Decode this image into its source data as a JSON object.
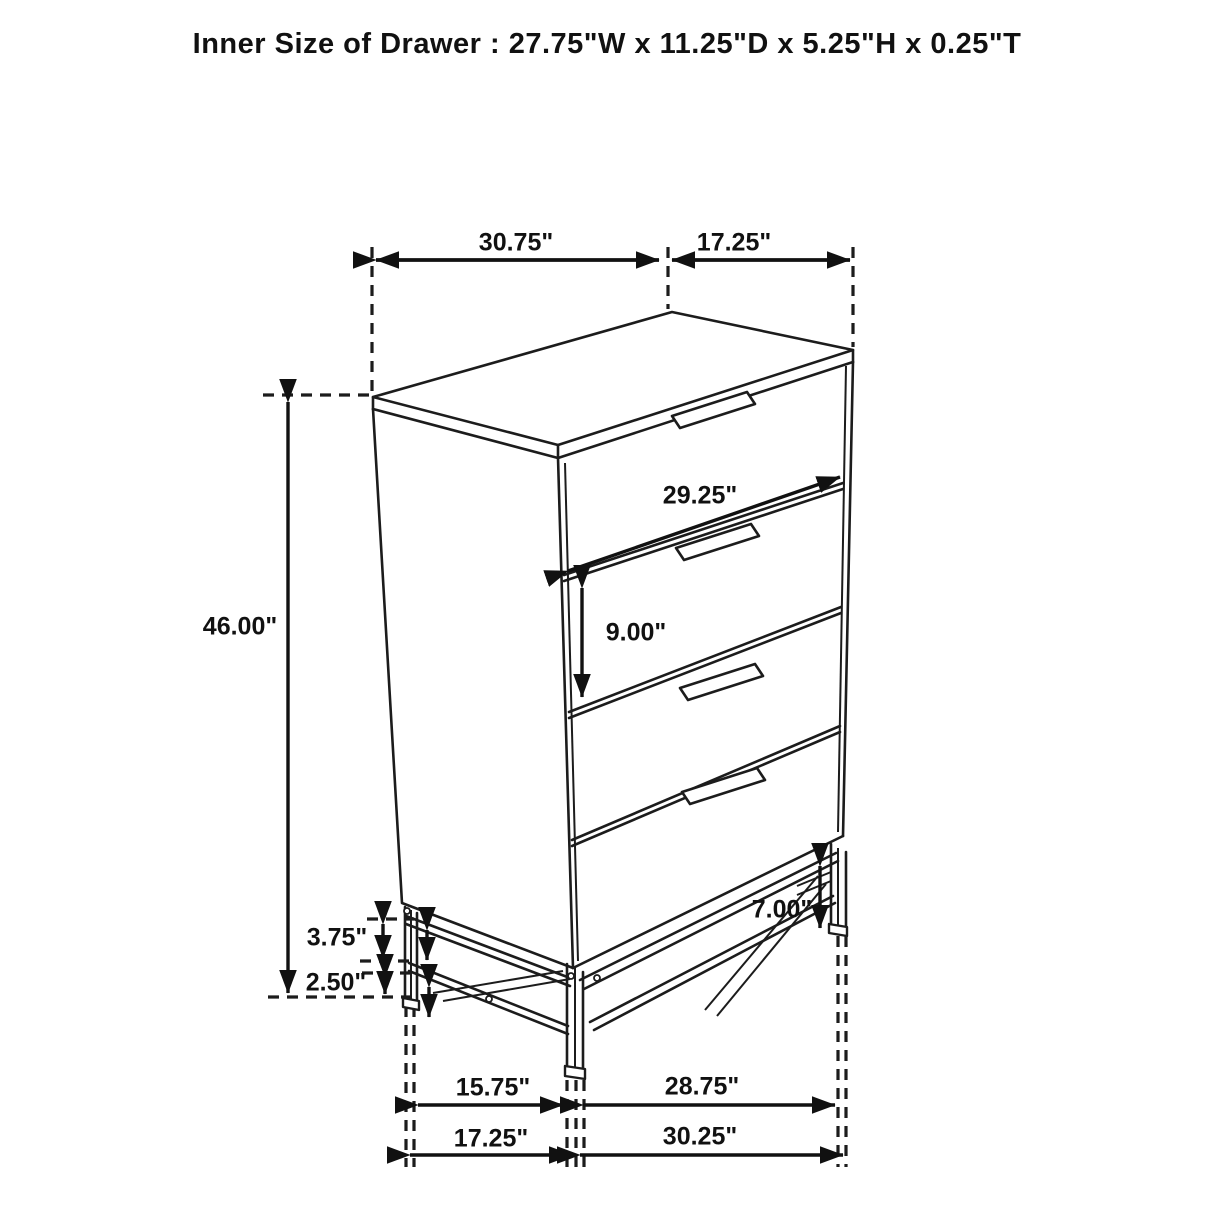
{
  "title": "Inner Size of Drawer : 27.75\"W x 11.25\"D x 5.25\"H x 0.25\"T",
  "diagram": {
    "subject": "4-drawer chest with metal base",
    "style": "black line technical dimension drawing",
    "line_color": "#1c1c1c",
    "text_color": "#111111",
    "background": "#ffffff"
  },
  "dimensions": {
    "top_width": "30.75\"",
    "top_depth": "17.25\"",
    "drawer_front_width": "29.25\"",
    "drawer_front_height": "9.00\"",
    "overall_height": "46.00\"",
    "base_frame_height": "3.75\"",
    "base_clearance": "2.50\"",
    "leg_height": "7.00\"",
    "base_inner_side": "15.75\"",
    "base_inner_front": "28.75\"",
    "base_outer_side": "17.25\"",
    "base_outer_front": "30.25\""
  }
}
